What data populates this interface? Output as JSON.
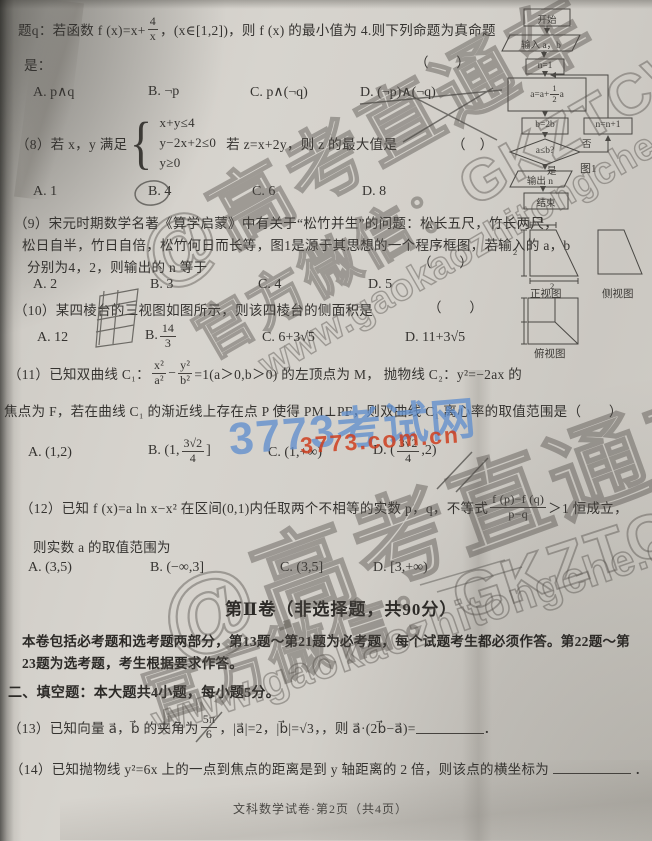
{
  "q7": {
    "line1a": "题q：若函数 f (x)=x+",
    "frac1": {
      "n": "4",
      "d": "x"
    },
    "line1b": "，(x∈[1,2])，则 f (x) 的最小值为 4.则下列命题为真命题",
    "line2": "是：",
    "bracket": "（　　）",
    "opts": [
      "A. p∧q",
      "B. ¬p",
      "C. p∧(¬q)",
      "D. (¬p)∧(¬q)"
    ]
  },
  "q8": {
    "pre": "（8）若 x，y 满足",
    "brace": "{",
    "sys": [
      "x+y≤4",
      "y−2x+2≤0",
      "y≥0"
    ],
    "post": "若 z=x+2y，则 z 的最大值是",
    "bracket": "（　）",
    "opts": [
      "A. 1",
      "B. 4",
      "C. 6",
      "D. 8"
    ]
  },
  "q9": {
    "line1": "（9）宋元时期数学名著《算学启蒙》中有关于“松竹并生”的问题：松长五尺，竹长两尺，",
    "line2": "松日自半，竹日自倍，松竹何日而长等，图1是源于其思想的一个程序框图，若输入的 a，b",
    "line3": "分别为4，2，则输出的 n 等于",
    "bracket": "（　　）",
    "opts": [
      "A. 2",
      "B. 3",
      "C. 4",
      "D. 5"
    ]
  },
  "q10": {
    "line": "（10）某四棱台的三视图如图所示，则该四棱台的侧面积是",
    "bracket": "（　　）",
    "optA": "A. 12",
    "optB_label": "B.",
    "optB_frac": {
      "n": "14",
      "d": "3"
    },
    "optC": "C. 6+3√5",
    "optD": "D. 11+3√5"
  },
  "q11": {
    "l1a": "（11）已知双曲线 C₁：",
    "f1": {
      "n": "x²",
      "d": "a²"
    },
    "minus": "−",
    "f2": {
      "n": "y²",
      "d": "b²"
    },
    "l1b": "=1(a＞0,b＞0) 的左顶点为 M，  抛物线 C₂：y²=−2ax 的",
    "l2": "焦点为 F，若在曲线 C₁ 的渐近线上存在点 P 使得 PM⊥PF，则双曲线 C₁ 离心率的取值范围是",
    "bracket": "（　　）",
    "optA": "A. (1,2)",
    "optB_pre": "B. (1,",
    "optB_frac": {
      "n": "3√2",
      "d": "4"
    },
    "optB_post": "]",
    "optC": "C. (1,+∞)",
    "optD_pre": "D. (",
    "optD_frac": {
      "n": "3√2",
      "d": "4"
    },
    "optD_post": ",2)"
  },
  "q12": {
    "l1a": "（12）已知 f (x)=a ln x−x² 在区间(0,1)内任取两个不相等的实数 p，q，不等式",
    "frac": {
      "n": "f (p)−f (q)",
      "d": "p−q"
    },
    "l1b": "＞1 恒成立，",
    "l2": "则实数 a 的取值范围为",
    "opts": [
      "A. (3,5)",
      "B. (−∞,3]",
      "C. (3,5]",
      "D. [3,+∞)"
    ]
  },
  "section2": {
    "title": "第Ⅱ卷（非选择题，共90分）",
    "para1": "本卷包括必考题和选考题两部分，第13题～第21题为必考题，每个试题考生都必须作答。第22题～第",
    "para2": "23题为选考题，考生根据要求作答。",
    "fill_header": "二、填空题：本大题共4小题，每小题5分。"
  },
  "q13": {
    "a": "（13）已知向量 a⃗，b⃗ 的夹角为",
    "frac": {
      "n": "5π",
      "d": "6"
    },
    "b": "，|a⃗|=2，|b⃗|=√3，，则 a⃗·(2b⃗−a⃗)=",
    "end": "．"
  },
  "q14": {
    "a": "（14）已知抛物线 y²=6x 上的一点到焦点的距离是到 y 轴距离的 2 倍，则该点的横坐标为",
    "end": "．"
  },
  "footer": "文科数学试卷·第2页（共4页）",
  "flowchart": {
    "start": "开始",
    "input": "输入 a，b",
    "init": "n=1",
    "assign_pre": "a=a+",
    "assign_frac": {
      "n": "1",
      "d": "2"
    },
    "assign_post": "a",
    "assign_b": "b=2b",
    "cond": "a≤b?",
    "yes": "是",
    "no": "否",
    "inc": "n=n+1",
    "output": "输出 n",
    "end": "结束",
    "caption": "图1"
  },
  "views": {
    "front": "正视图",
    "side": "侧视图",
    "top": "俯视图",
    "dim_top": "1",
    "dim_left": "2",
    "dim_bottom": "2"
  },
  "watermarks": {
    "brand": "@高考直通车",
    "wechat": "官方微信：GKZTCWX",
    "url": "www.gaokaozhitongche.com",
    "site_blue": "3773考试网",
    "site_red": "3773.com.cn",
    "blue_color": "#608ecd",
    "red_color": "#ce3e1e"
  }
}
